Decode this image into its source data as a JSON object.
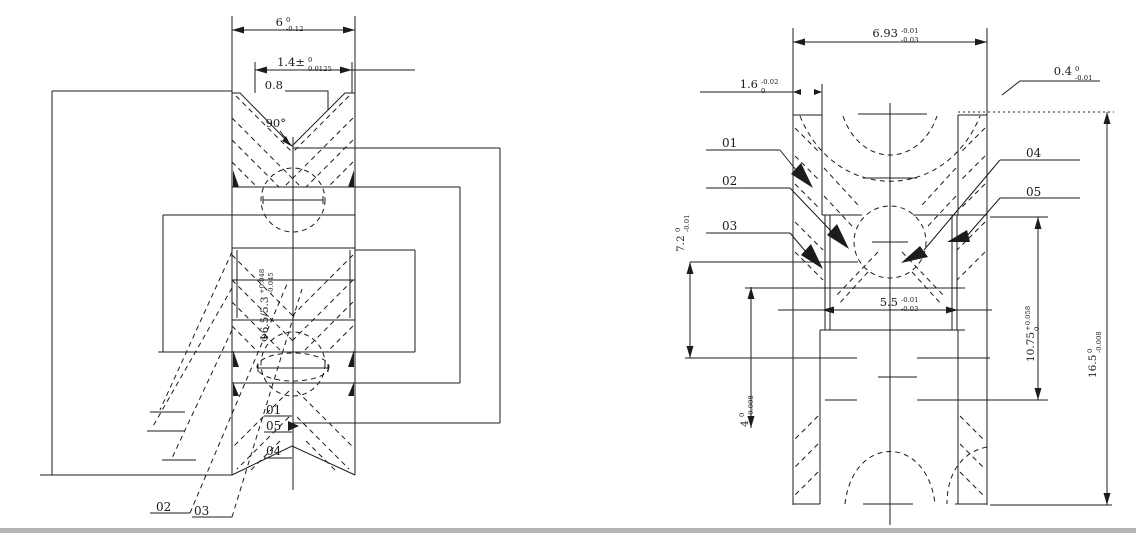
{
  "page": {
    "background": "#ffffff",
    "line_color": "#1c1c1c",
    "scan_edge_color": "#b5b5b5"
  },
  "left_view": {
    "name": "axial cross-section view",
    "dims": {
      "width": {
        "value": "6",
        "sup": "0",
        "sub": "-0.12"
      },
      "groove_width": {
        "value": "1.4±",
        "sup": "0",
        "sub": "0.0125"
      },
      "chamfer": {
        "value": "0.8"
      },
      "groove_angle": {
        "value": "90°"
      },
      "bore": {
        "value": "Φ6.5/5.3",
        "sup": "+0.048",
        "sub": "-0.045"
      }
    },
    "labels": {
      "p01": "01",
      "p05": "05",
      "p04": "04",
      "p02": "02",
      "p03": "03"
    }
  },
  "right_view": {
    "name": "detail cross-section view",
    "dims": {
      "outer_width": {
        "value": "6.93",
        "sup": "-0.01",
        "sub": "-0.03"
      },
      "flange_width": {
        "value": "1.6",
        "sup": "-0.02",
        "sub": "0"
      },
      "lip_width": {
        "value": "0.4",
        "sup": "0",
        "sub": "-0.01"
      },
      "groove_depth": {
        "value": "7.2",
        "sup": "0",
        "sub": "-0.01"
      },
      "inner_width": {
        "value": "5.5",
        "sup": "-0.01",
        "sub": "-0.03"
      },
      "bore_dia": {
        "value": "10.75",
        "sup": "+0.058",
        "sub": "0"
      },
      "outer_dia": {
        "value": "16.5",
        "sup": "0",
        "sub": "-0.008"
      },
      "step_dia": {
        "value": "4",
        "sup": "0",
        "sub": "-0.008"
      }
    },
    "labels": {
      "p01": "01",
      "p02": "02",
      "p03": "03",
      "p04": "04",
      "p05": "05"
    }
  }
}
